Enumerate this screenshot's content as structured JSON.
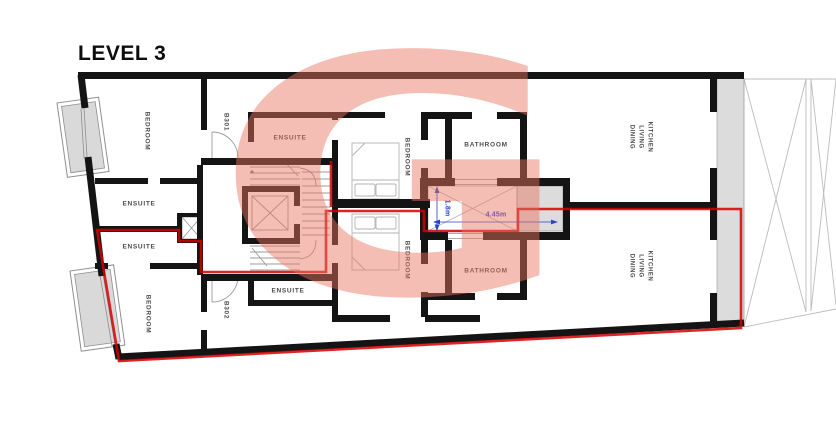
{
  "title": "LEVEL 3",
  "watermark": {
    "letter": "G"
  },
  "colors": {
    "wall": "#141414",
    "route": "#d40000",
    "dimension": "#2743c7",
    "watermark_pink": "#e87460",
    "shaft_fill": "#dcdcdc",
    "balcony_fill": "#d9d9d9"
  },
  "rooms": {
    "bedroom_tl": "BEDROOM",
    "ensuite_l1": "ENSUITE",
    "ensuite_l2": "ENSUITE",
    "bedroom_bl": "BEDROOM",
    "unit_t": "B301",
    "unit_b": "B302",
    "ensuite_tc": "ENSUITE",
    "ensuite_bc": "ENSUITE",
    "bedroom_mt": "BEDROOM",
    "bedroom_mb": "BEDROOM",
    "bathroom_t": "BATHROOM",
    "bathroom_b": "BATHROOM",
    "kitchen_t": {
      "line1": "KITCHEN",
      "line2": "LIVING",
      "line3": "DINING"
    },
    "kitchen_b": {
      "line1": "KITCHEN",
      "line2": "LIVING",
      "line3": "DINING"
    }
  },
  "dimensions": {
    "lightwell_width": "4.45m",
    "lightwell_depth": "1.8m"
  }
}
